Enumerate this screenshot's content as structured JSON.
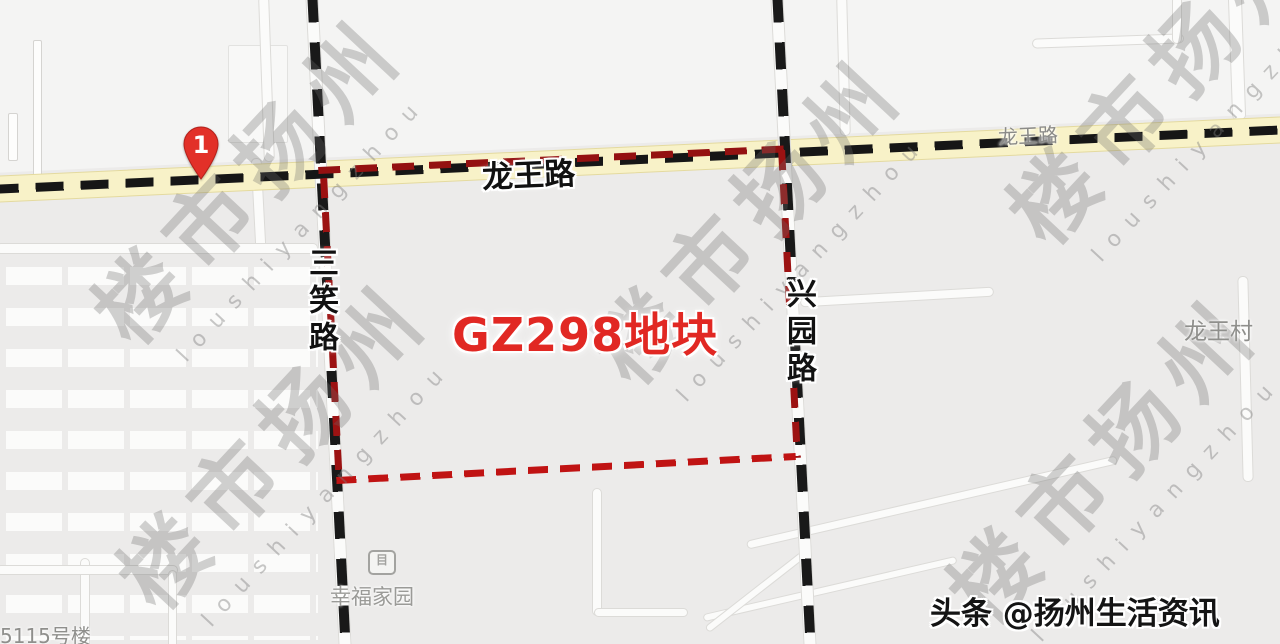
{
  "map": {
    "roads": {
      "longwang_main_label": "龙王路",
      "longwang_far_label": "龙王路",
      "sanxiao_label": "三笑路",
      "xingyuan_label": "兴园路"
    },
    "places": {
      "longwang_village": "龙王村",
      "xingfu_homes": "幸福家园",
      "building_5115": "5115号楼",
      "poi_glyph": "目"
    },
    "parcel": {
      "label": "GZ298地块"
    },
    "marker": {
      "number": "1"
    }
  },
  "watermark": {
    "cn": "楼市扬州",
    "en": "loushiyangzhou"
  },
  "caption": {
    "full": "头条 @扬州生活资讯"
  },
  "colors": {
    "background": "#ecebea",
    "road_yellow": "#f8f2c8",
    "route_dash_black": "#161616",
    "boundary_red": "#c01313",
    "parcel_text_red": "#e12823",
    "pin_red": "#e23028",
    "label_gray": "#8f8f8c"
  }
}
